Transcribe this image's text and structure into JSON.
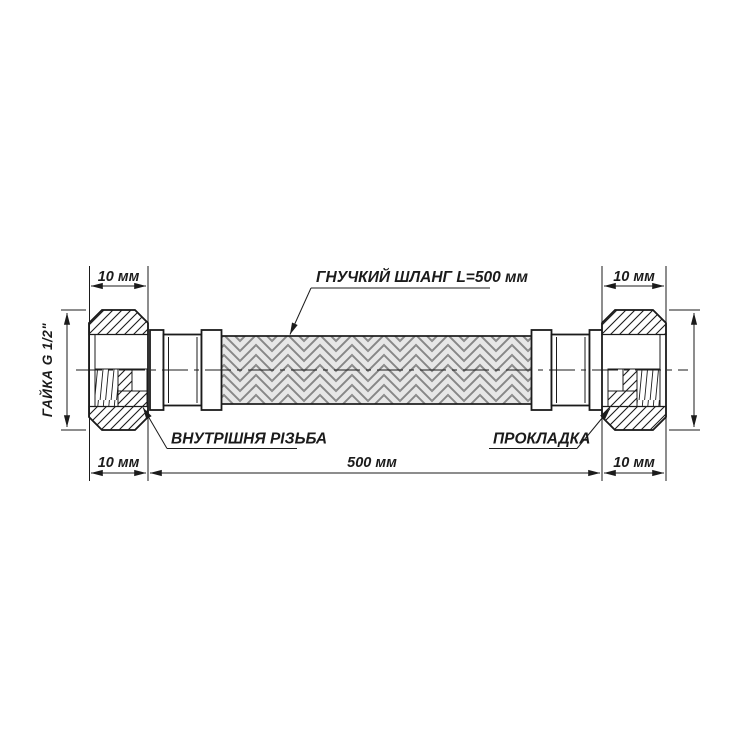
{
  "drawing": {
    "type": "technical-drawing",
    "subject": "flexible braided hose with nuts",
    "callouts": {
      "hose": "ГНУЧКИЙ ШЛАНГ L=500 мм",
      "internal_thread": "ВНУТРІШНЯ РІЗЬБА",
      "gasket": "ПРОКЛАДКА"
    },
    "side_labels": {
      "left_nut": "ГАЙКА G 1/2\"",
      "right_nut": "ГАЙКА G 1/2\""
    },
    "dimensions": {
      "top_left": "10 мм",
      "top_right": "10 мм",
      "bottom_left": "10 мм",
      "bottom_center": "500 мм",
      "bottom_right": "10 мм"
    },
    "colors": {
      "line": "#1b1b1b",
      "background": "#ffffff",
      "braid_strand": "#e7e7e7",
      "braid_edge": "#878787",
      "braid_gap": "#c4c4c4"
    }
  }
}
